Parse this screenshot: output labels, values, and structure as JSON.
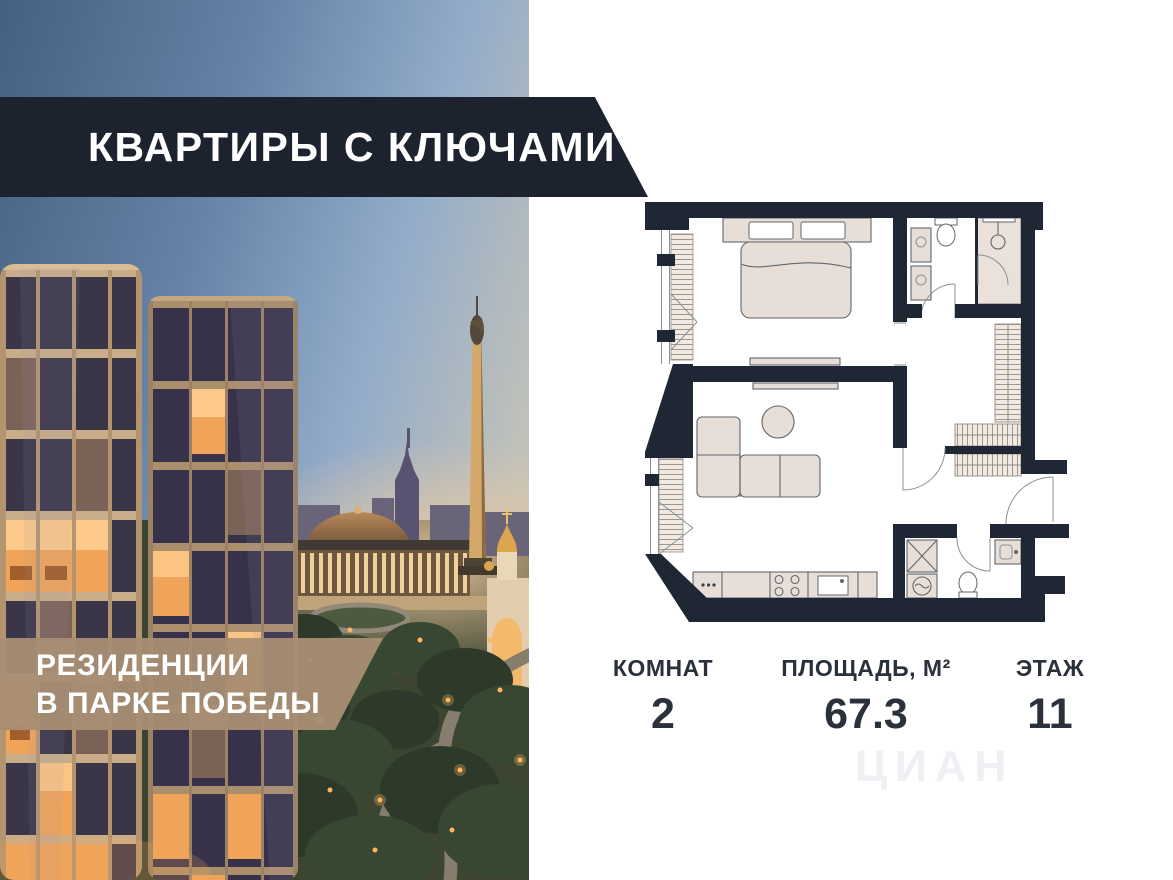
{
  "headline_banner": {
    "title": "КВАРТИРЫ С КЛЮЧАМИ",
    "bg_color": "#1c232e",
    "text_color": "#ffffff"
  },
  "residence_banner": {
    "line1": "РЕЗИДЕНЦИИ",
    "line2": "В ПАРКЕ ПОБЕДЫ",
    "bg_color": "#a88e74",
    "text_color": "#ffffff"
  },
  "stats": {
    "items": [
      {
        "label": "КОМНАТ",
        "value": "2"
      },
      {
        "label": "ПЛОЩАДЬ, М²",
        "value": "67.3"
      },
      {
        "label": "ЭТАЖ",
        "value": "11"
      }
    ],
    "text_color": "#2a313b"
  },
  "floor_plan": {
    "type": "2-room apartment plan",
    "wall_color": "#1e2733",
    "furniture_color": "#e7dfd7",
    "rooms": [
      "bedroom",
      "living-room-with-kitchen",
      "bathroom",
      "laundry-wc",
      "hallway-with-wardrobes"
    ]
  },
  "photo": {
    "scene": "residential towers at dusk over Victory Park, Moscow",
    "sky_top_color": "#47607e",
    "sky_light_color": "#93acc9",
    "lit_window_color": "#f0a459",
    "tower_frame_color": "#b3946f"
  },
  "watermark": {
    "text": "ЦИАН"
  }
}
